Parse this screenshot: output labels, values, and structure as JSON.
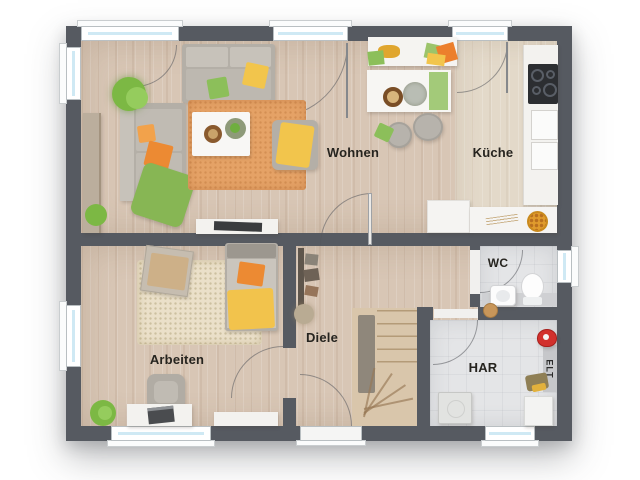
{
  "palette": {
    "wall": "#565a61",
    "floor_wood": "#d8c6b5",
    "floor_wood_light": "#e3d9c9",
    "floor_tile": "#e4e5e7",
    "window_glass": "#cfe9f4",
    "rug_orange": "#e5a266",
    "rug_beige": "#ebe0c9",
    "accent_orange": "#ec8a33",
    "accent_yellow": "#f2c54c",
    "accent_green": "#8cbf5a",
    "alert_red": "#d2302c"
  },
  "rooms": {
    "wohnen": {
      "label": "Wohnen"
    },
    "kueche": {
      "label": "Küche"
    },
    "arbeiten": {
      "label": "Arbeiten"
    },
    "diele": {
      "label": "Diele"
    },
    "wc": {
      "label": "WC"
    },
    "har": {
      "label": "HAR"
    },
    "elt": {
      "label": "ELT"
    }
  }
}
